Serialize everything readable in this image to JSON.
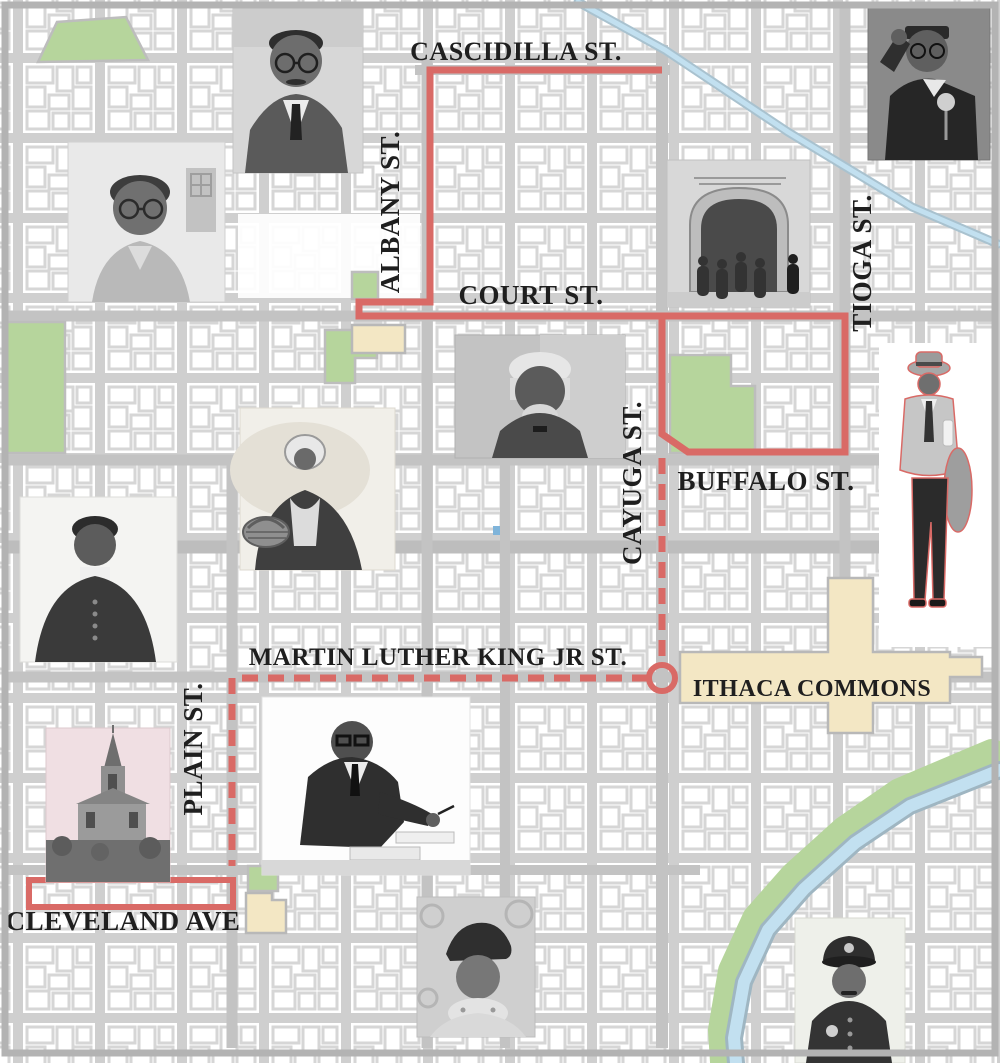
{
  "map": {
    "streets": {
      "cascidilla": "CASCIDILLA ST.",
      "albany": "ALBANY ST.",
      "court": "COURT ST.",
      "tioga": "TIOGA ST.",
      "cayuga": "CAYUGA ST.",
      "buffalo": "BUFFALO ST.",
      "mlk": "MARTIN LUTHER KING JR ST.",
      "plain": "PLAIN ST.",
      "cleveland": "CLEVELAND AVE"
    },
    "areas": {
      "commons": "ITHACA COMMONS"
    },
    "photos": [
      "portrait-woman-with-glasses",
      "portrait-alex-haley",
      "portrait-malcolm-x",
      "group-exiting-stone-building",
      "portrait-frederick-douglass",
      "seated-woman-with-basket",
      "portrait-harriet-tubman",
      "walking-man-with-coat",
      "man-writing-at-desk",
      "church-building",
      "woman-in-beret-and-scarf",
      "police-officer"
    ],
    "colors": {
      "route_red": "#d96a66",
      "park_green": "#b6d59c",
      "commons_tan": "#f3e7c4",
      "water_blue": "#c2e0f0",
      "street_gray": "#c7c7c7",
      "label_ink": "#1f1f1f"
    }
  }
}
